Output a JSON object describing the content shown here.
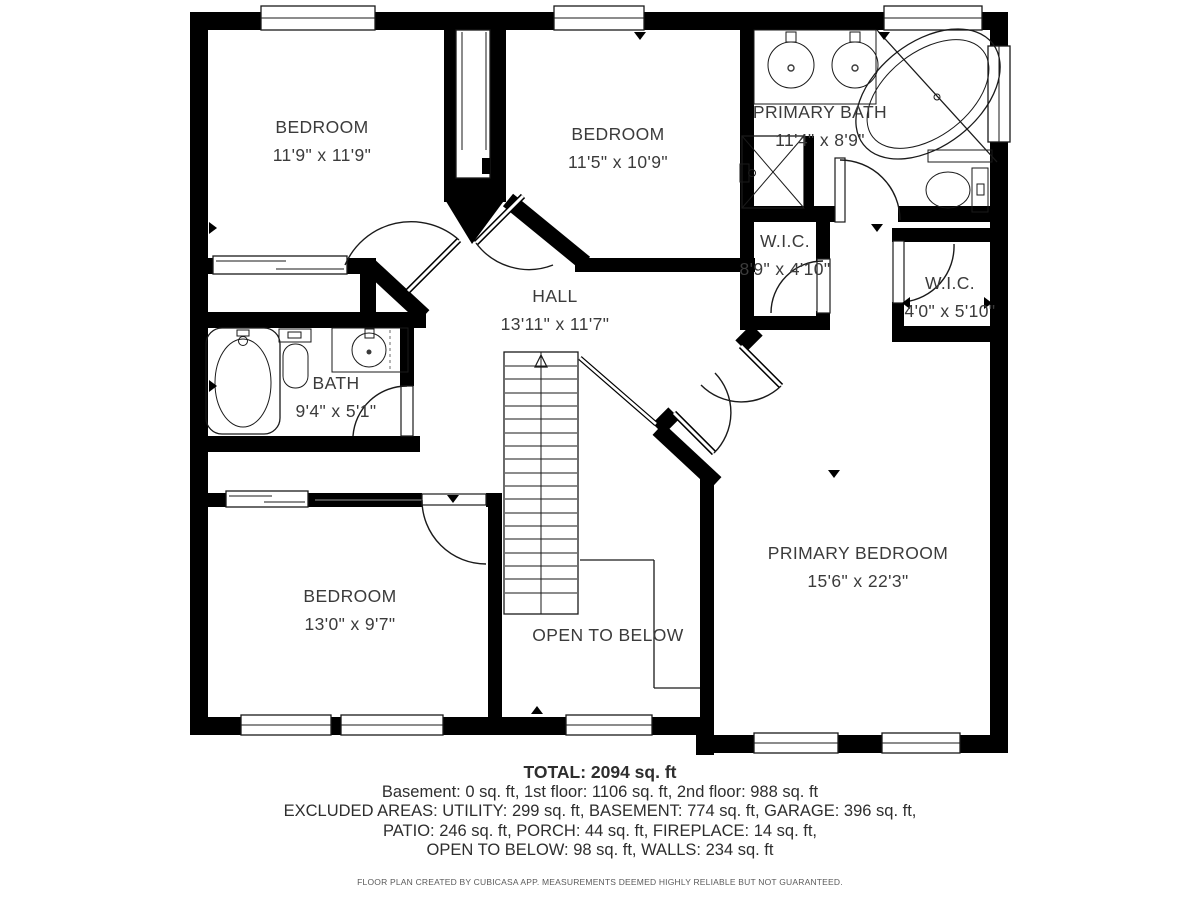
{
  "floorplan": {
    "rooms": [
      {
        "name": "BEDROOM",
        "dims": "11'9\" x 11'9\""
      },
      {
        "name": "BEDROOM",
        "dims": "11'5\" x 10'9\""
      },
      {
        "name": "PRIMARY BATH",
        "dims": "11'4\" x 8'9\""
      },
      {
        "name": "W.I.C.",
        "dims": "8'9\" x 4'10\""
      },
      {
        "name": "W.I.C.",
        "dims": "4'0\" x 5'10\""
      },
      {
        "name": "HALL",
        "dims": "13'11\" x 11'7\""
      },
      {
        "name": "BATH",
        "dims": "9'4\" x 5'1\""
      },
      {
        "name": "BEDROOM",
        "dims": "13'0\" x 9'7\""
      },
      {
        "name": "OPEN TO BELOW",
        "dims": ""
      },
      {
        "name": "PRIMARY BEDROOM",
        "dims": "15'6\" x 22'3\""
      }
    ],
    "summary": {
      "total": "TOTAL: 2094 sq. ft",
      "line1": "Basement: 0 sq. ft, 1st floor: 1106 sq. ft, 2nd floor: 988 sq. ft",
      "line2": "EXCLUDED AREAS: UTILITY: 299 sq. ft, BASEMENT: 774 sq. ft, GARAGE: 396 sq. ft,",
      "line3": "PATIO: 246 sq. ft, PORCH: 44 sq. ft, FIREPLACE: 14 sq. ft,",
      "line4": "OPEN TO BELOW: 98 sq. ft, WALLS: 234 sq. ft",
      "disclaimer": "FLOOR PLAN CREATED BY CUBICASA APP. MEASUREMENTS DEEMED HIGHLY RELIABLE BUT NOT GUARANTEED."
    }
  }
}
